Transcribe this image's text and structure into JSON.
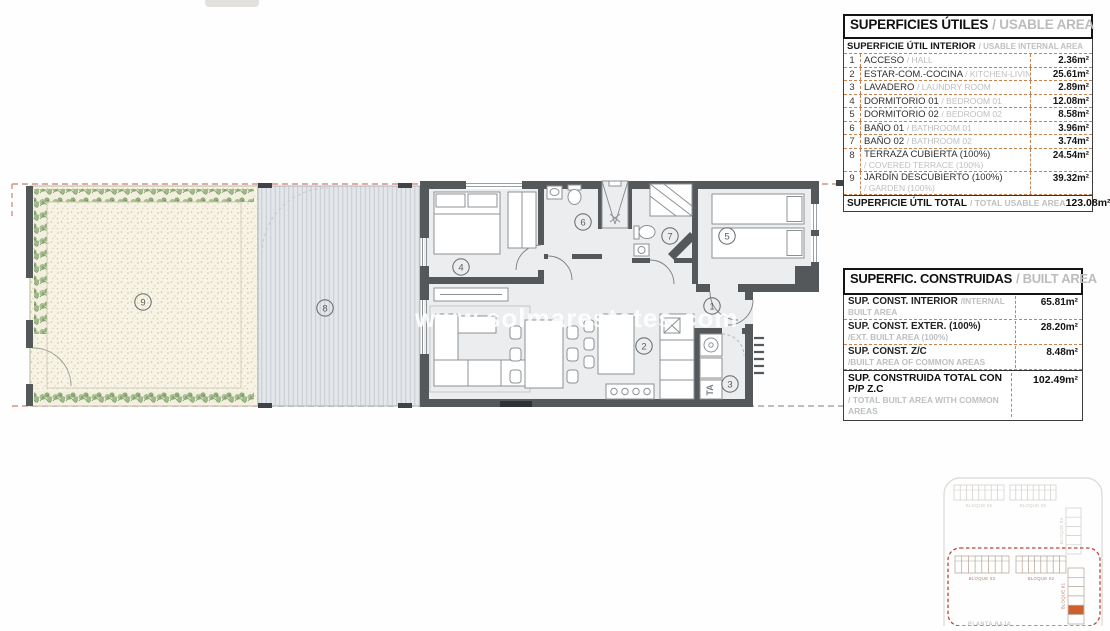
{
  "floorplan": {
    "watermark": "www.solmarestates.com",
    "room_numbers": {
      "hall": "1",
      "kitchen_living": "2",
      "laundry": "3",
      "bedroom_01": "4",
      "bedroom_02": "5",
      "bathroom_01": "6",
      "bathroom_02": "7",
      "covered_terrace": "8",
      "garden": "9"
    },
    "laundry_ta_label": "TA"
  },
  "usable_table": {
    "title_es": "SUPERFICIES ÚTILES",
    "title_en": "/ USABLE AREA",
    "subheader_es": "SUPERFICIE ÚTIL INTERIOR",
    "subheader_en": "/ USABLE INTERNAL AREA",
    "rows": [
      {
        "num": "1",
        "es": "ACCESO",
        "en": "/ HALL",
        "value": "2.36m²"
      },
      {
        "num": "2",
        "es": "ESTAR-COM.-COCINA",
        "en": "/ KITCHEN-LIVING",
        "value": "25.61m²"
      },
      {
        "num": "3",
        "es": "LAVADERO",
        "en": "/ LAUNDRY ROOM",
        "value": "2.89m²"
      },
      {
        "num": "4",
        "es": "DORMITORIO 01",
        "en": "/ BEDROOM 01",
        "value": "12.08m²"
      },
      {
        "num": "5",
        "es": "DORMITORIO 02",
        "en": "/ BEDROOM 02",
        "value": "8.58m²"
      },
      {
        "num": "6",
        "es": "BAÑO 01",
        "en": "/ BATHROOM 01",
        "value": "3.96m²"
      },
      {
        "num": "7",
        "es": "BAÑO 02",
        "en": "/ BATHROOM 02",
        "value": "3.74m²"
      },
      {
        "num": "8",
        "es": "TERRAZA CUBIERTA (100%)",
        "en": "/ COVERED TERRACE (100%)",
        "value": "24.54m²"
      },
      {
        "num": "9",
        "es": "JARDÍN DESCUBIERTO (100%)",
        "en": "/ GARDEN (100%)",
        "value": "39.32m²"
      }
    ],
    "total_es": "SUPERFICIE ÚTIL TOTAL",
    "total_en": "/ TOTAL USABLE AREA",
    "total_value": "123.08m²"
  },
  "built_table": {
    "title_es": "SUPERFIC. CONSTRUIDAS",
    "title_en": "/ BUILT AREA",
    "rows": [
      {
        "es": "SUP. CONST. INTERIOR",
        "en": "/INTERNAL BUILT AREA",
        "value": "65.81m²"
      },
      {
        "es": "SUP. CONST. EXTER. (100%)",
        "en": "/EXT. BUILT AREA (100%)",
        "value": "28.20m²"
      },
      {
        "es": "SUP. CONST. Z/C",
        "en": "/BUILT AREA OF COMMON AREAS",
        "value": "8.48m²"
      }
    ],
    "total_es": "SUP. CONSTRUIDA TOTAL CON P/P Z.C",
    "total_en": "/ TOTAL BUILT AREA WITH COMMON AREAS",
    "total_value": "102.49m²"
  },
  "site_plan": {
    "blocks": {
      "b06": "BLOQUE 06",
      "b05": "BLOQUE 05",
      "b04": "BLOQUE 04",
      "b03": "BLOQUE 03",
      "b02": "BLOQUE 02",
      "b01": "BLOQUE 01"
    },
    "floor_label": "PLANTA BAJA"
  },
  "colors": {
    "wall": "#54585b",
    "dash_orange": "#c8824f",
    "boundary_red": "#d29384",
    "hedge_green": "#9cb487",
    "highlight_unit": "#cf5f2d"
  }
}
